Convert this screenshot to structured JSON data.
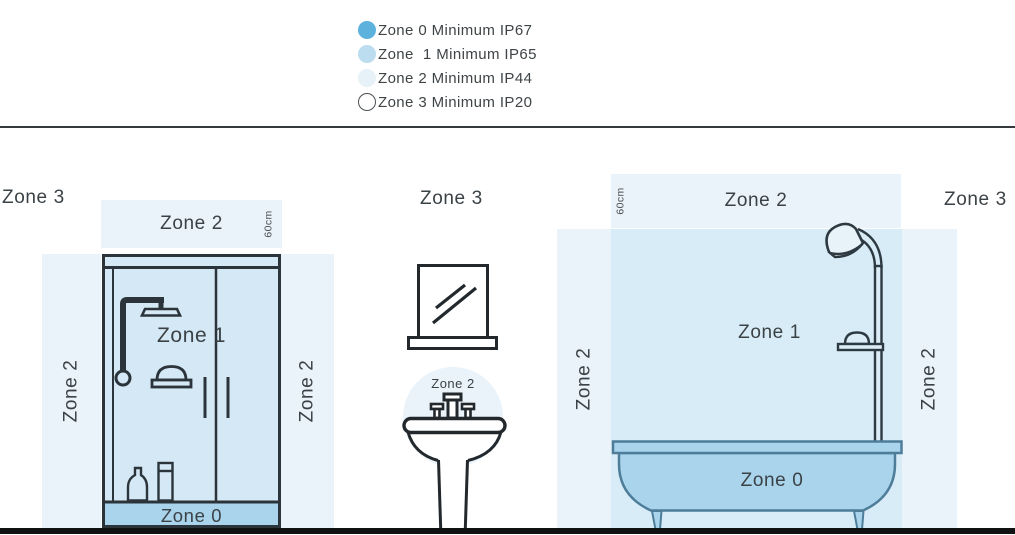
{
  "legend": {
    "items": [
      {
        "label": "Zone 0 Minimum IP67",
        "color": "#5cb2dc",
        "outlined": false,
        "border": ""
      },
      {
        "label": "Zone  1 Minimum IP65",
        "color": "#bcdcf0",
        "outlined": false,
        "border": ""
      },
      {
        "label": "Zone 2 Minimum IP44",
        "color": "#e7f1f8",
        "outlined": false,
        "border": ""
      },
      {
        "label": "Zone 3 Minimum IP20",
        "color": "#ffffff",
        "outlined": true,
        "border": "#4b5054"
      }
    ]
  },
  "shower": {
    "outside_label": "Zone 3",
    "top_band_label": "Zone 2",
    "left_band_label": "Zone 2",
    "right_band_label": "Zone 2",
    "inner_label": "Zone 1",
    "tray_label": "Zone 0",
    "dim_band": "60cm",
    "dim_wall": "60cm"
  },
  "basin": {
    "outside_label": "Zone 3",
    "circle_label": "Zone 2"
  },
  "bath": {
    "outside_label": "Zone 3",
    "top_band_label": "Zone 2",
    "left_band_label": "Zone 2",
    "right_band_label": "Zone 2",
    "inner_label": "Zone 1",
    "tub_label": "Zone 0",
    "dim_band": "60cm",
    "dim_wall": "60cm"
  },
  "colors": {
    "zone0_swatch": "#5cb2dc",
    "zone1_swatch": "#bcdcf0",
    "zone2_swatch": "#e7f1f8",
    "zone2_band_fill": "#eaf3fa",
    "zone1_region_fill": "#d8ecf7",
    "shower_interior_fill": "#d5e8f5",
    "zone0_fill": "#a9d4ec",
    "outline_dark": "#2a343a",
    "tub_outline": "#4e7d99",
    "text": "#3b4246"
  }
}
